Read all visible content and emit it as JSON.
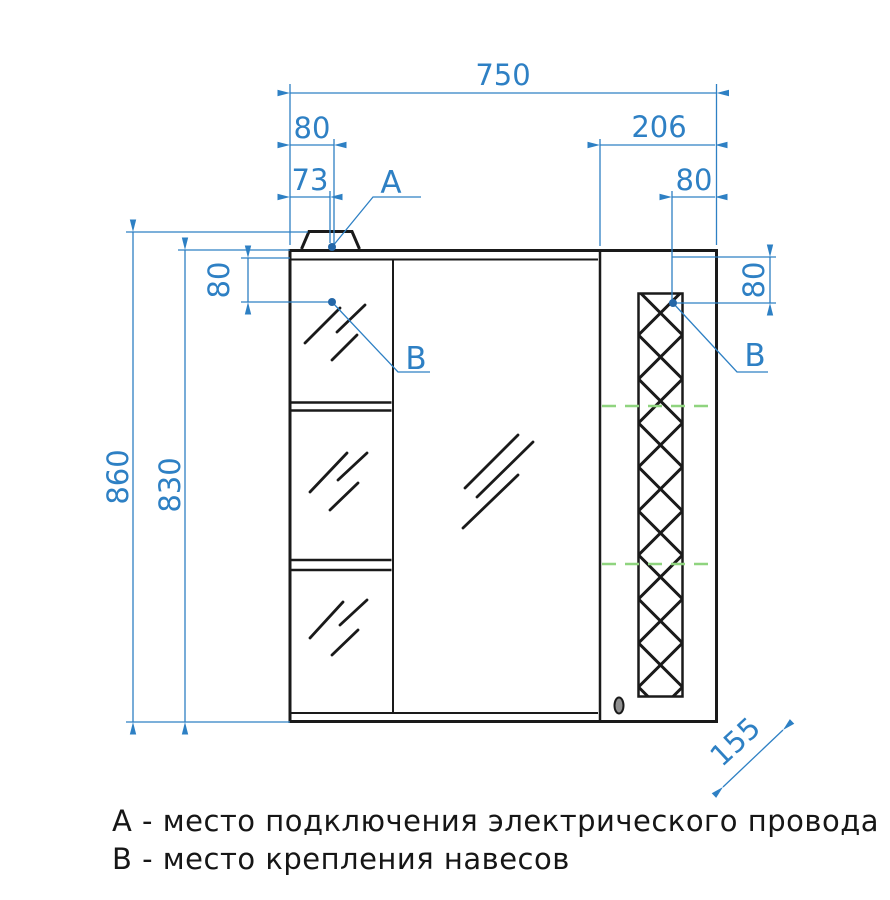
{
  "drawing": {
    "title": "Mirror cabinet front-view technical drawing",
    "dimensions": {
      "overall_width": "750",
      "wire_offset_outer": "80",
      "wire_offset_inner": "73",
      "right_section_width": "206",
      "right_bracket_offset": "80",
      "left_bracket_drop": "80",
      "overall_height": "860",
      "body_height": "830",
      "right_bracket_drop": "80",
      "depth": "155"
    },
    "point_labels": {
      "a": "А",
      "b_left": "В",
      "b_right": "В"
    },
    "legend": {
      "a_line": "А - место подключения электрического провода",
      "b_line": "В - место крепления навесов"
    },
    "colors": {
      "dimension_blue": "#2e80c4",
      "outline_black": "#1a1a1a",
      "centerline_green": "#8fd47f"
    }
  }
}
